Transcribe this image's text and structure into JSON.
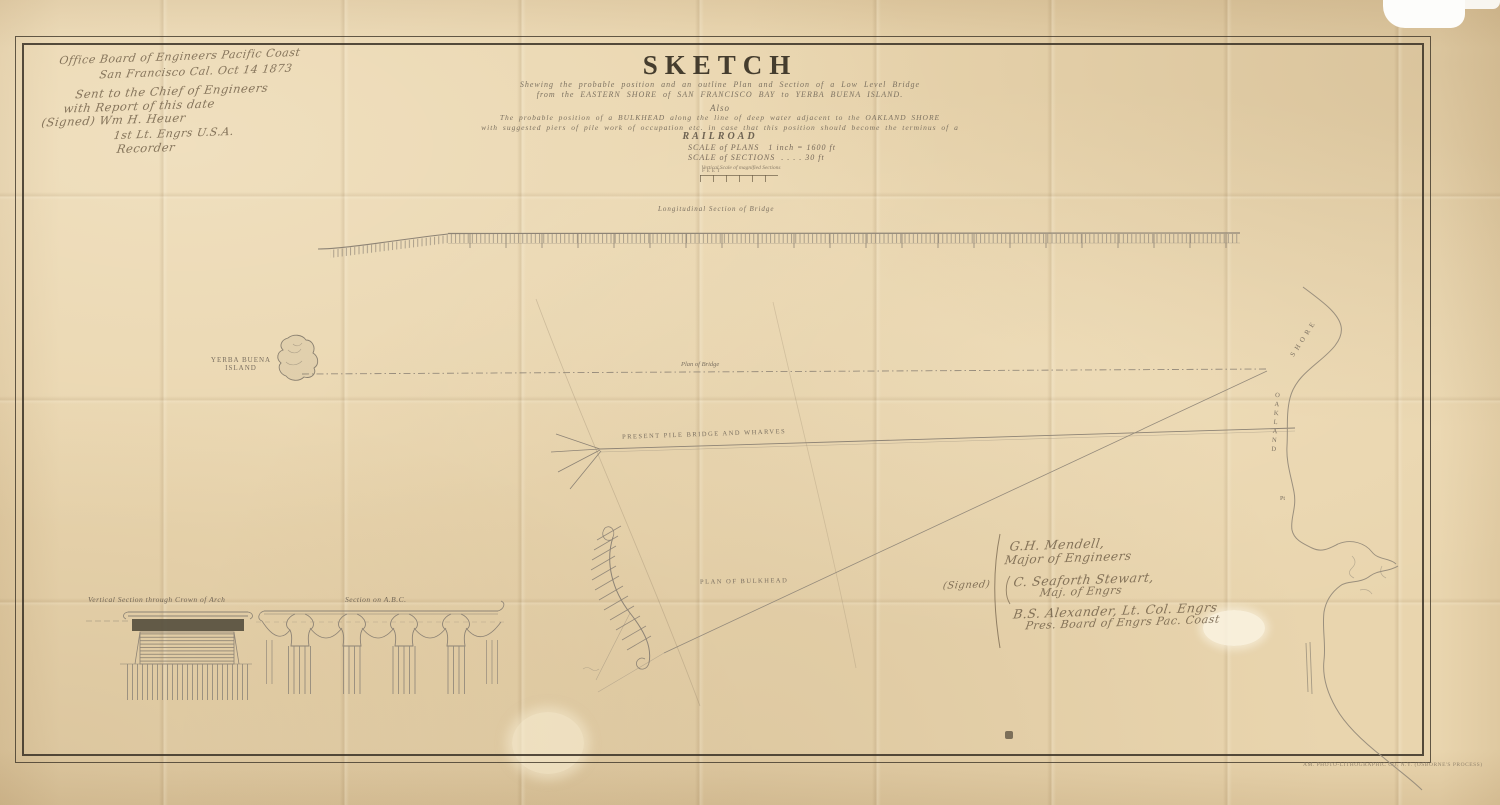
{
  "handwritten_note": {
    "line1": "Office Board of Engineers Pacific Coast",
    "line2": "San Francisco Cal. Oct 14 1873",
    "line3": "Sent to the Chief of Engineers",
    "line4": "with Report of this date",
    "line5": "(Signed) Wm H. Heuer",
    "line6": "1st Lt. Engrs U.S.A.",
    "line7": "Recorder"
  },
  "title_block": {
    "title": "SKETCH",
    "subtitle1": "Shewing the probable position and an outline Plan and Section of a Low Level Bridge",
    "subtitle2": "from the EASTERN SHORE of SAN FRANCISCO BAY to YERBA BUENA ISLAND.",
    "also": "Also",
    "body1": "The probable position of a BULKHEAD along the line of deep water adjacent to the OAKLAND SHORE",
    "body2": "with suggested piers of pile work of occupation etc. in case that this position should become the terminus of a",
    "railroad": "RAILROAD",
    "scale_plans_label": "SCALE of PLANS",
    "scale_plans_value": "1 inch = 1600 ft",
    "scale_sections_label": "SCALE of SECTIONS",
    "scale_sections_value": ". . . . 30 ft",
    "scale_note": "Vertical Scale of magnified Sections",
    "scale_bar_unit": "FEET"
  },
  "map_labels": {
    "longitudinal_section": "Longitudinal Section of Bridge",
    "plan_of_bridge": "Plan of Bridge",
    "island_line1": "YERBA BUENA",
    "island_line2": "ISLAND",
    "pile_bridge": "PRESENT PILE BRIDGE AND WHARVES",
    "bulkhead": "PLAN OF BULKHEAD",
    "shore_word": "SHORE",
    "oakland_word": "OAKLAND",
    "oakland_pt": "Pt"
  },
  "section_labels": {
    "vertical_section": "Vertical Section through Crown of Arch",
    "section_abc": "Section on A.B.C."
  },
  "signatures": {
    "signed": "(Signed)",
    "sig1_name": "G.H. Mendell,",
    "sig1_title": "Major of Engineers",
    "sig2_name": "C. Seaforth Stewart,",
    "sig2_title": "Maj. of Engrs",
    "sig3_name": "B.S. Alexander,  Lt. Col. Engrs",
    "sig3_title": "Pres. Board of Engrs Pac. Coast"
  },
  "imprint": "AM. PHOTO-LITHOGRAPHIC CO. N.Y. (OSBORNE'S PROCESS)",
  "colors": {
    "paper": "#e9d5ae",
    "ink": "#453d2e",
    "drawing_line": "#8d8375",
    "handwriting": "#6e5d46"
  }
}
